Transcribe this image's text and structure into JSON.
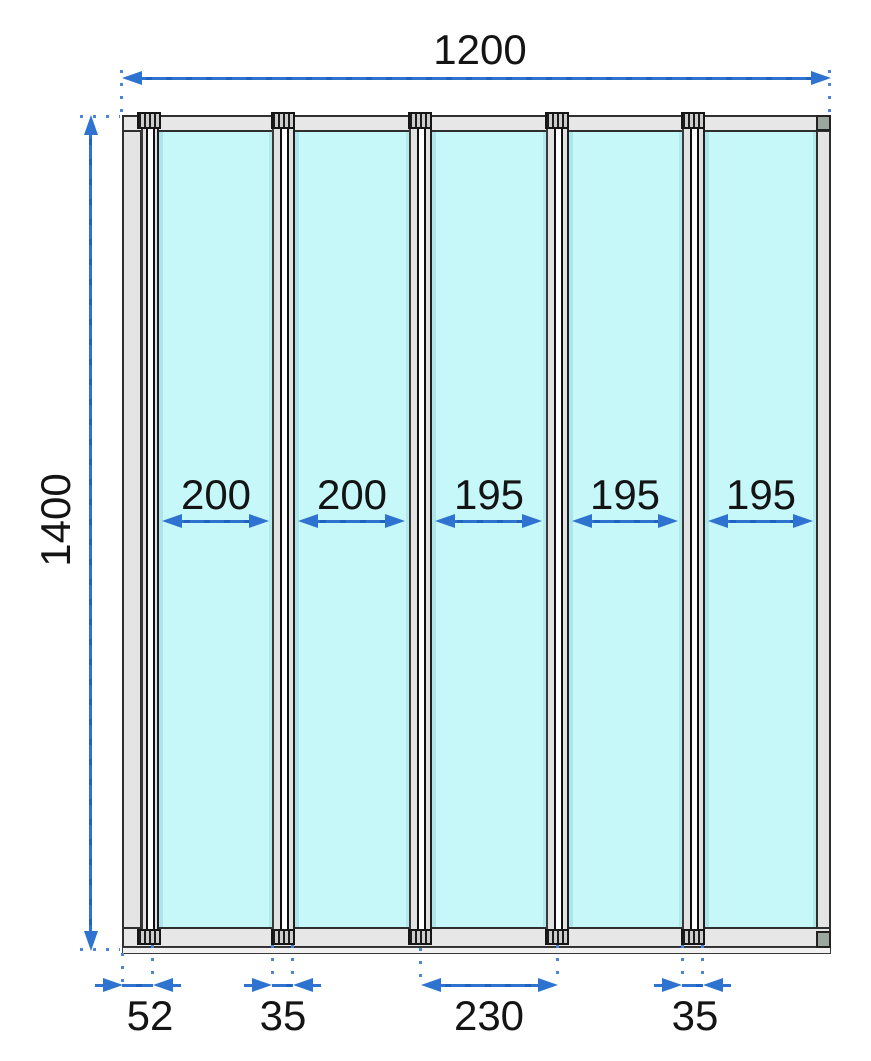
{
  "drawing": {
    "type": "technical-dimension-drawing",
    "subject": "five-panel folding glass screen front view",
    "dimensions": {
      "overall_width": "1200",
      "overall_height": "1400",
      "panel_widths": [
        {
          "label": "200"
        },
        {
          "label": "200"
        },
        {
          "label": "195"
        },
        {
          "label": "195"
        },
        {
          "label": "195"
        }
      ],
      "bottom": [
        {
          "label": "52"
        },
        {
          "label": "35"
        },
        {
          "label": "230"
        },
        {
          "label": "35"
        }
      ]
    },
    "colors": {
      "dimension_blue": "#2d73cf",
      "glass_cyan": "#c6f7f9",
      "frame_gray": "#e4e4e4",
      "frame_outline": "#2f2f2f",
      "corner_block": "#9ba79f",
      "background": "#ffffff",
      "text": "#141414"
    }
  }
}
